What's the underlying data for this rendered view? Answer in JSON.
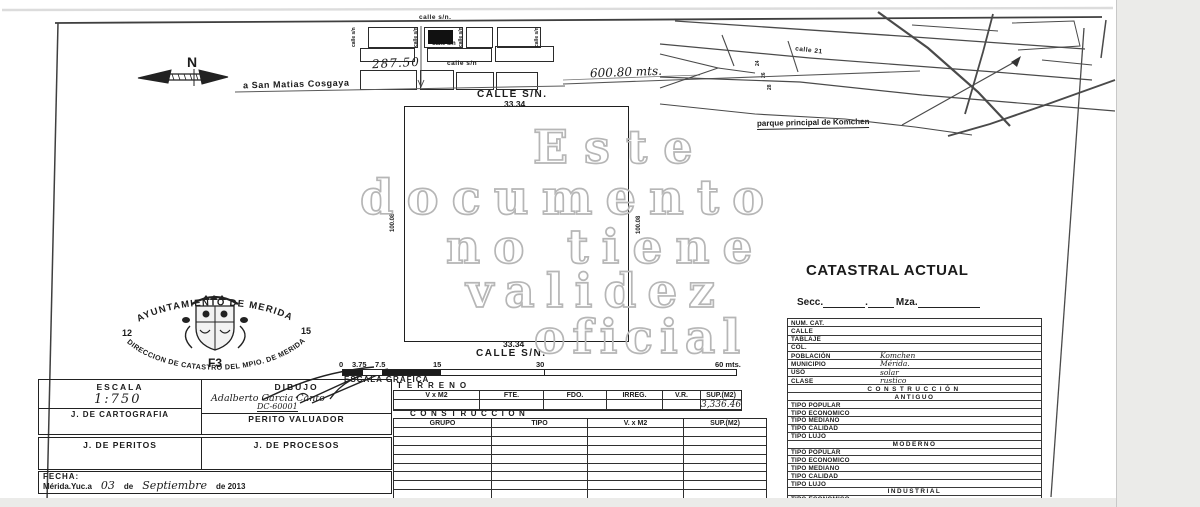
{
  "document": {
    "watermark": [
      "Este",
      "documento",
      "no tiene",
      "validez",
      "oficial"
    ]
  },
  "compass": {
    "north": "N"
  },
  "top_sketch": {
    "calle_top": "calle s/n.",
    "calle_mid": "calle s/n",
    "calle_row3": "calle s/n",
    "calle_vertical": "calle s/n",
    "dim_287": "287.50",
    "dim_600": "600.80 mts.",
    "road_to": "a San Matias Cosgaya"
  },
  "parcel": {
    "street_top": "CALLE S/N.",
    "street_bottom": "CALLE S/N.",
    "front_top": "33.34",
    "front_bottom": "33.34",
    "depth_left": "100.08",
    "depth_right": "100.08"
  },
  "location_map": {
    "street": "calle 21",
    "numbers": [
      "24",
      "26",
      "28"
    ],
    "poi": "parque principal de Komchen"
  },
  "catastral": {
    "title": "CATASTRAL ACTUAL",
    "secc": "Secc.",
    "mza": "Mza.",
    "fields": [
      {
        "label": "NUM. CAT.",
        "value": ""
      },
      {
        "label": "CALLE",
        "value": ""
      },
      {
        "label": "TABLAJE",
        "value": ""
      },
      {
        "label": "COL.",
        "value": ""
      },
      {
        "label": "POBLACIÓN",
        "value": "Komchen"
      },
      {
        "label": "MUNICIPIO",
        "value": "Mérida."
      },
      {
        "label": "USO",
        "value": "solar"
      },
      {
        "label": "CLASE",
        "value": "rustico"
      }
    ],
    "construccion": "CONSTRUCCIÓN",
    "sections": [
      {
        "header": "ANTIGUO",
        "rows": [
          "TIPO POPULAR",
          "TIPO ECONOMICO",
          "TIPO MEDIANO",
          "TIPO CALIDAD",
          "TIPO LUJO"
        ]
      },
      {
        "header": "MODERNO",
        "rows": [
          "TIPO POPULAR",
          "TIPO ECONOMICO",
          "TIPO MEDIANO",
          "TIPO CALIDAD",
          "TIPO LUJO"
        ]
      },
      {
        "header": "INDUSTRIAL",
        "rows": [
          "TIPO ECONOMICO",
          "TIPO MEDIO",
          "TIPO SUPERIOR"
        ]
      }
    ]
  },
  "seal": {
    "top_arc": "AYUNTAMIENTO DE MERIDA",
    "bottom_arc": "DIRECCION DE CATASTRO DEL MPIO. DE MERIDA",
    "left_num": "12",
    "right_num": "15",
    "code": "F3"
  },
  "scale_bar": {
    "ticks": [
      "0",
      "3.75",
      "7.5",
      "15",
      "30",
      "60 mts."
    ],
    "label": "ESCALA GRAFICA"
  },
  "terreno": {
    "title": "TERRENO",
    "headers": [
      "V x M2",
      "FTE.",
      "FDO.",
      "IRREG.",
      "V.R.",
      "SUP.(M2)"
    ],
    "sup_value": "3,336.46"
  },
  "construccion_table": {
    "title": "CONSTRUCCION",
    "headers": [
      "GRUPO",
      "TIPO",
      "V. x M2",
      "SUP.(M2)"
    ]
  },
  "info": {
    "escala_label": "ESCALA",
    "escala_value": "1:750",
    "dibujo_label": "DIBUJO",
    "dibujo_name": "Adalberto Garcia Canto",
    "dibujo_code": "DC-60001",
    "cartografia": "J. DE CARTOGRAFIA",
    "perito": "PERITO VALUADOR",
    "peritos": "J. DE PERITOS",
    "procesos": "J. DE PROCESOS",
    "fecha_label": "FECHA:",
    "fecha_place": "Mérida.Yuc.a",
    "fecha_day": "03",
    "fecha_de": "de",
    "fecha_month": "Septiembre",
    "fecha_year": "de 2013"
  }
}
